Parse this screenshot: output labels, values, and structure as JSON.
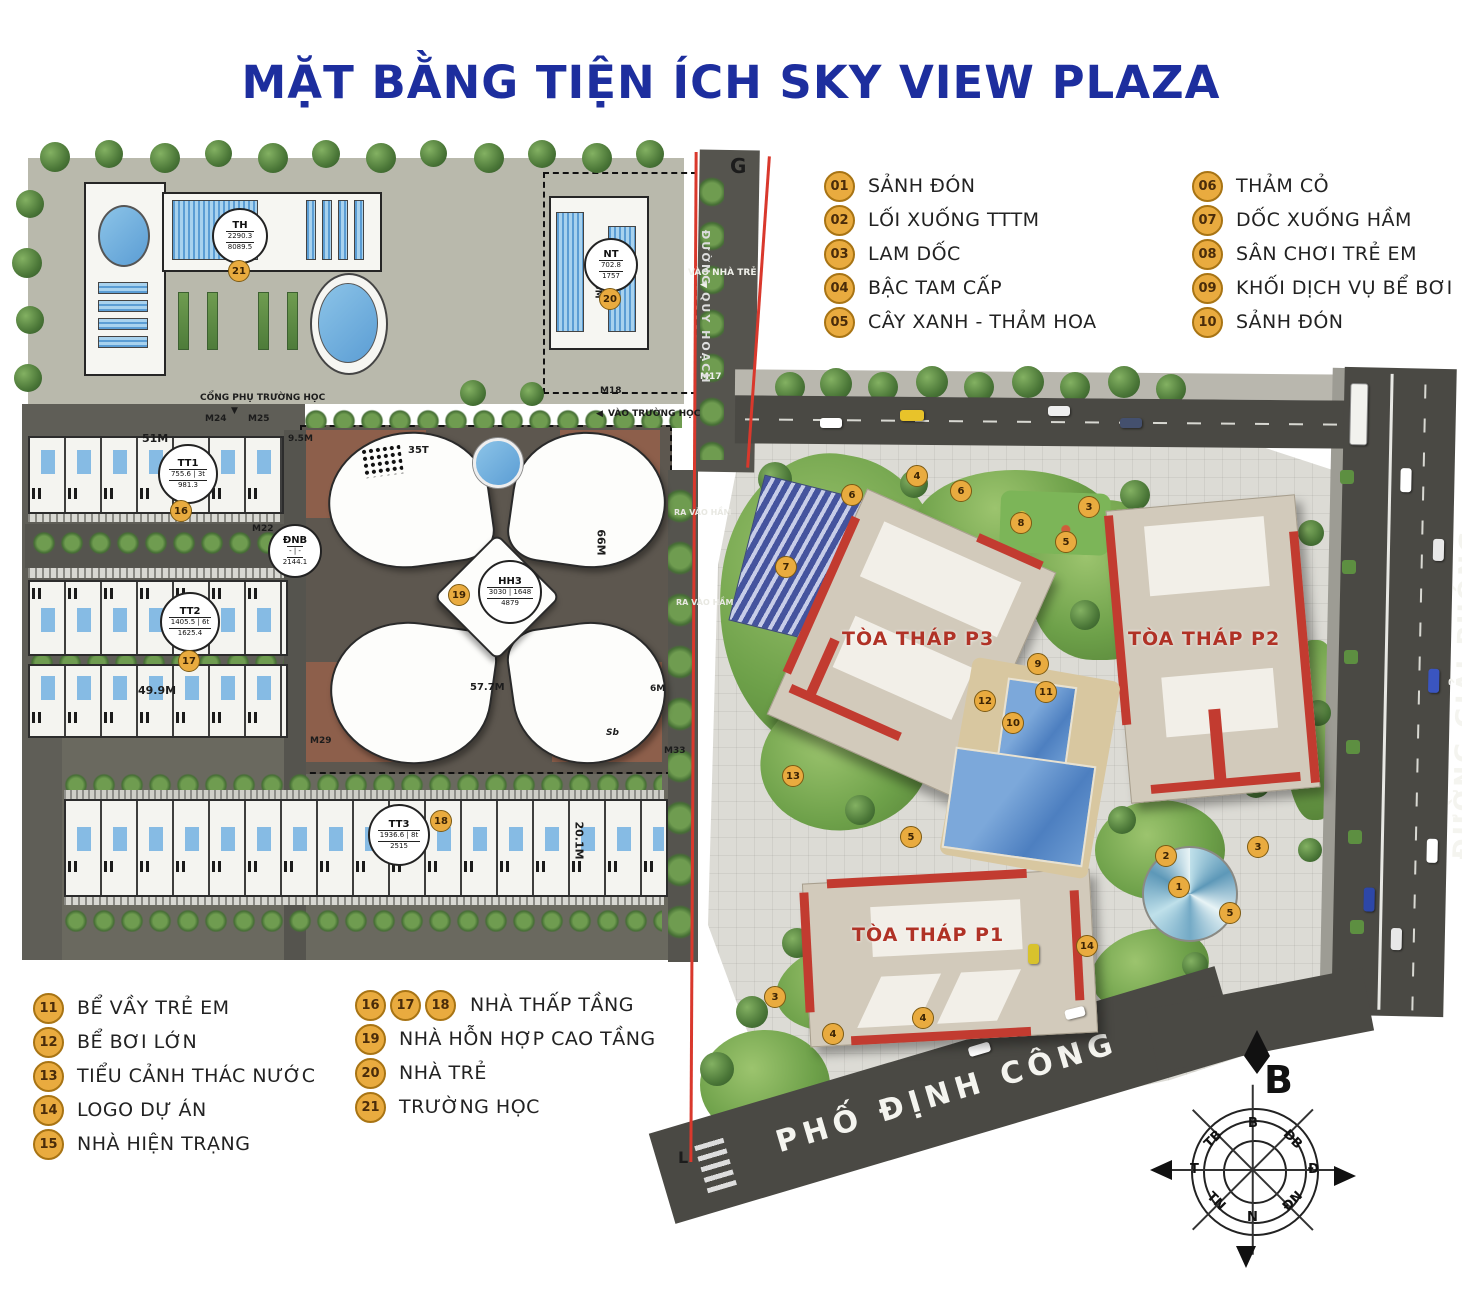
{
  "title": "MẶT BẰNG TIỆN ÍCH SKY VIEW PLAZA",
  "colors": {
    "title_blue": "#1d2e9e",
    "badge_fill": "#e9ab3f",
    "badge_border": "#a87414",
    "boundary_red": "#d9382c",
    "tower_label_red": "#b03226"
  },
  "legend_top": {
    "col1": [
      {
        "num": "01",
        "label": "SẢNH ĐÓN"
      },
      {
        "num": "02",
        "label": "LỐI XUỐNG TTTM"
      },
      {
        "num": "03",
        "label": "LAM DỐC"
      },
      {
        "num": "04",
        "label": "BẬC TAM CẤP"
      },
      {
        "num": "05",
        "label": "CÂY XANH - THẢM HOA"
      }
    ],
    "col2": [
      {
        "num": "06",
        "label": "THẢM CỎ"
      },
      {
        "num": "07",
        "label": "DỐC XUỐNG HẦM"
      },
      {
        "num": "08",
        "label": "SÂN CHƠI TRẺ EM"
      },
      {
        "num": "09",
        "label": "KHỐI DỊCH VỤ BỂ BƠI"
      },
      {
        "num": "10",
        "label": "SẢNH ĐÓN"
      }
    ]
  },
  "legend_bottom": {
    "col1": [
      {
        "num": "11",
        "label": "BỂ VẦY TRẺ EM"
      },
      {
        "num": "12",
        "label": "BỂ BƠI LỚN"
      },
      {
        "num": "13",
        "label": "TIỂU CẢNH THÁC NƯỚC"
      },
      {
        "num": "14",
        "label": "LOGO DỰ ÁN"
      },
      {
        "num": "15",
        "label": "NHÀ HIỆN TRẠNG"
      }
    ],
    "col2": [
      {
        "nums": [
          "16",
          "17",
          "18"
        ],
        "label": "NHÀ THẤP TẦNG"
      },
      {
        "nums": [
          "19"
        ],
        "label": "NHÀ HỖN HỢP CAO TẦNG"
      },
      {
        "nums": [
          "20"
        ],
        "label": "NHÀ TRẺ"
      },
      {
        "nums": [
          "21"
        ],
        "label": "TRƯỜNG HỌC"
      }
    ]
  },
  "towers": {
    "p1": "TÒA THÁP P1",
    "p2": "TÒA THÁP P2",
    "p3": "TÒA THÁP P3"
  },
  "roads": {
    "dinh_cong": "PHỐ ĐỊNH CÔNG",
    "giai_phong": "ĐƯỜNG GIẢI PHÓNG",
    "quy_hoach": "ĐƯỜNG QUY HOẠCH"
  },
  "plots": {
    "th": {
      "code": "TH",
      "line1": "2290.3",
      "line2": "8089.5",
      "badge": "21"
    },
    "nt": {
      "code": "NT",
      "line1": "702.8",
      "line2": "1757",
      "badge": "20"
    },
    "tt1": {
      "code": "TT1",
      "line1": "755.6 | 3t",
      "line2": "981.3",
      "badge": "16"
    },
    "tt2": {
      "code": "TT2",
      "line1": "1405.5 | 6t",
      "line2": "1625.4",
      "badge": "17"
    },
    "tt3": {
      "code": "TT3",
      "line1": "1936.6 | 8t",
      "line2": "2515",
      "badge": "18"
    },
    "dnb": {
      "code": "ĐNB",
      "line1": "-  |  -",
      "line2": "2144.1"
    },
    "hh3": {
      "code": "HH3",
      "line1": "3030 | 1648",
      "line2": "4879",
      "badge": "19"
    }
  },
  "site_labels": {
    "cong_phu_truong_hoc": "CỔNG PHỤ TRƯỜNG HỌC",
    "vao_truong_hoc": "VÀO TRƯỜNG HỌC",
    "vao_nha_tre": "VÀO NHÀ TRẺ",
    "ra_vao_ham": "RA VÀO HẦM",
    "arrow_left": "◀",
    "arrow_down": "▼"
  },
  "markers": {
    "g": "G",
    "l": "L",
    "m17": "M17",
    "m18": "M18",
    "m22": "M22",
    "m24": "M24",
    "m25": "M25",
    "m29": "M29",
    "m33": "M33"
  },
  "dims": {
    "d51": "51M",
    "d95": "9.5M",
    "d499": "49.9M",
    "d201": "20.1M",
    "d66": "66M",
    "d577": "57.7M",
    "d465": "46.5M",
    "d6": "6M",
    "d35t": "35T",
    "sb": "Sb"
  },
  "compass": {
    "north": "B",
    "points": [
      "B",
      "ĐB",
      "Đ",
      "ĐN",
      "N",
      "TN",
      "T",
      "TB"
    ]
  },
  "map_badges": [
    "4",
    "6",
    "6",
    "3",
    "8",
    "5",
    "7",
    "13",
    "12",
    "11",
    "10",
    "9",
    "5",
    "2",
    "1",
    "3",
    "5",
    "14",
    "3",
    "4",
    "4"
  ]
}
